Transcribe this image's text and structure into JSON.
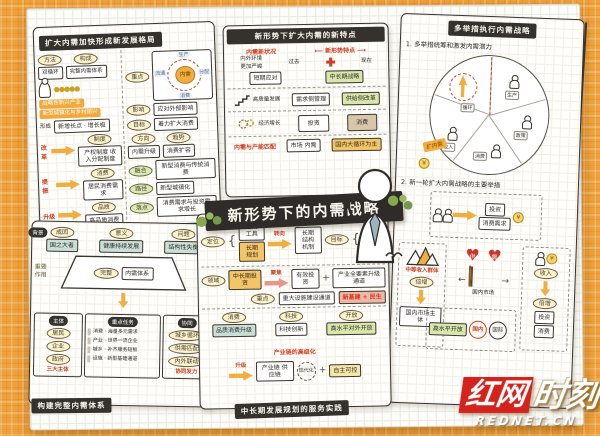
{
  "colors": {
    "background_orange": "#EFA23C",
    "accent_orange": "#F1AE3E",
    "ink": "#35312C",
    "red_accent": "#CF3F23",
    "watermark_red": "#D5231C",
    "green_box": "#D9E6AC",
    "teal_box": "#C9DFD8"
  },
  "center_banner": "新形势下的内需战略",
  "watermark": {
    "brand_red": "红网",
    "brand_white": "时刻",
    "domain": "REDNET.CN"
  },
  "p1": {
    "title": "扩大内需加快形成新发展格局",
    "top1_oval": "方法",
    "top1_box": "双循环",
    "top2_oval": "构成",
    "top2_box": "完整内需体系",
    "highlight_line1": "战略性新兴产业",
    "highlight_line2": "新型城镇化与乡村振兴",
    "form_label": "形成",
    "form_box": "新增长点 · 增长极",
    "rows": [
      {
        "tag": "改革",
        "oval": "制度",
        "box": "产权制度 收入分配制度"
      },
      {
        "tag": "提振",
        "oval": "消费",
        "box": "居民消费需求"
      },
      {
        "tag": "升级",
        "oval": "品质",
        "box": "高品质消费"
      },
      {
        "tag": "拓展",
        "oval": "场景",
        "box": "消费新场景"
      }
    ],
    "cycle": {
      "oval": "重点",
      "center": "内需",
      "n": "生产",
      "e": "分配",
      "s": "消费",
      "w": "流通"
    },
    "r_items": [
      {
        "oval": "影响",
        "box": "应对外部影响"
      },
      {
        "oval": "目标",
        "box": "着力扩大消费"
      },
      {
        "oval": "方向",
        "box": "内需升级"
      },
      {
        "oval": "趋势",
        "box": "消费扩容"
      },
      {
        "oval": "融合",
        "box": "新型消费与传统消费"
      },
      {
        "oval": "路径",
        "box": "新型城镇化"
      },
      {
        "oval": "落点",
        "box": "消费需求与投资需求增长"
      }
    ]
  },
  "p2": {
    "title": "新形势下扩大内需的新特点",
    "red_left": "内需新状况",
    "note1": "内外环境",
    "note2": "更加严峻",
    "red_right": "新形势特点",
    "past": "过去",
    "now": "现在",
    "s1_past": "短期应对",
    "s1_now": "中长期战略",
    "s2_label": "高质量发展",
    "s2_past": "需求侧管理",
    "s2_now": "供给侧改革",
    "s3_label": "经济增长",
    "s3_past": "投资",
    "s3_now": "消费",
    "s4_red": "内需与产能匹配",
    "s4_past": "市场 内需",
    "s4_now": "国内大循环为主"
  },
  "p3": {
    "title": "多举措执行内需战略",
    "item1": "1. 多举措统筹和激发内需潜力",
    "item2": "2. 新一轮扩大内需战略的主要举措",
    "pie_tag": "扩内需",
    "pie_labels": [
      "循环",
      "生产",
      "政策",
      "消费",
      "收入"
    ],
    "m_top_box1": "投资",
    "m_top_box2": "消费需求",
    "m_left_red": "中等收入群体",
    "m_left_tag": "倍增",
    "m_left_box": "国内市场主体",
    "supply": "供",
    "demand": "需",
    "market": "国内市场",
    "m_right_oval": "收入",
    "m_right_tag": "倍增",
    "m_right_box1": "投资",
    "m_right_box2": "消费",
    "m_bottom_box": "高水平开放",
    "dual1": "国内",
    "dual2": "国际"
  },
  "p4": {
    "title": "构建完整内需体系",
    "corner": "背景",
    "groups": [
      {
        "oval": "成因",
        "box": "国之大者"
      },
      {
        "oval": "意义",
        "box": "健康持续发展"
      },
      {
        "oval": "问题",
        "box": "结构性失衡"
      }
    ],
    "trap_oval": "完整",
    "trap_box": "内需体系",
    "left_note1": "重要",
    "left_note2": "作用",
    "right_note1": "如何",
    "right_note2": "构建",
    "col1_head": "主体",
    "col1_items": [
      "居民",
      "企业",
      "政府"
    ],
    "col1_red": "三大主体",
    "col2_head": "重点任务",
    "col2_items": [
      "消费 · 海量多元需求",
      "产业 · 世界一流企业",
      "城乡 · 补齐服务短板",
      "设施 · 新型基建通道"
    ],
    "col3_head": "协同",
    "col3_items": [
      "城乡循环",
      "供需匹配",
      "内外联动"
    ],
    "col3_red": "协同发力"
  },
  "p5": {
    "title": "中长期发展规划的服务实践",
    "r1_oval": "定位",
    "r1_box1": "短期工具",
    "r1_box2": "长期规划",
    "r1_arrow": "转向",
    "r1_box3": "长期 结构 机制",
    "r1_oval2": "目标",
    "r1_list": [
      "稳增长预期",
      "拓内需空间",
      "改善民生"
    ],
    "r2_oval": "领域",
    "r2_box1": "中长期投资",
    "r2_arrow": "聚焦",
    "r2_box2": "有效投资",
    "r2_box3": "产业全要素升级通道",
    "r2_oval2": "重点",
    "r2_box4": "重大设施建设通道",
    "r2_red": "新基建 + 民生",
    "r3_groups": [
      {
        "oval": "消费",
        "box": "品质消费升级"
      },
      {
        "oval": "科技",
        "box": "科技创新"
      },
      {
        "oval": "开放",
        "box": "高水平对外开放"
      }
    ],
    "r3_red": "产业链的高级化",
    "r4_arrow": "升级",
    "r4_box1": "产业链 供应链",
    "r4_circle": "现代化",
    "r4_box2": "自主可控"
  }
}
